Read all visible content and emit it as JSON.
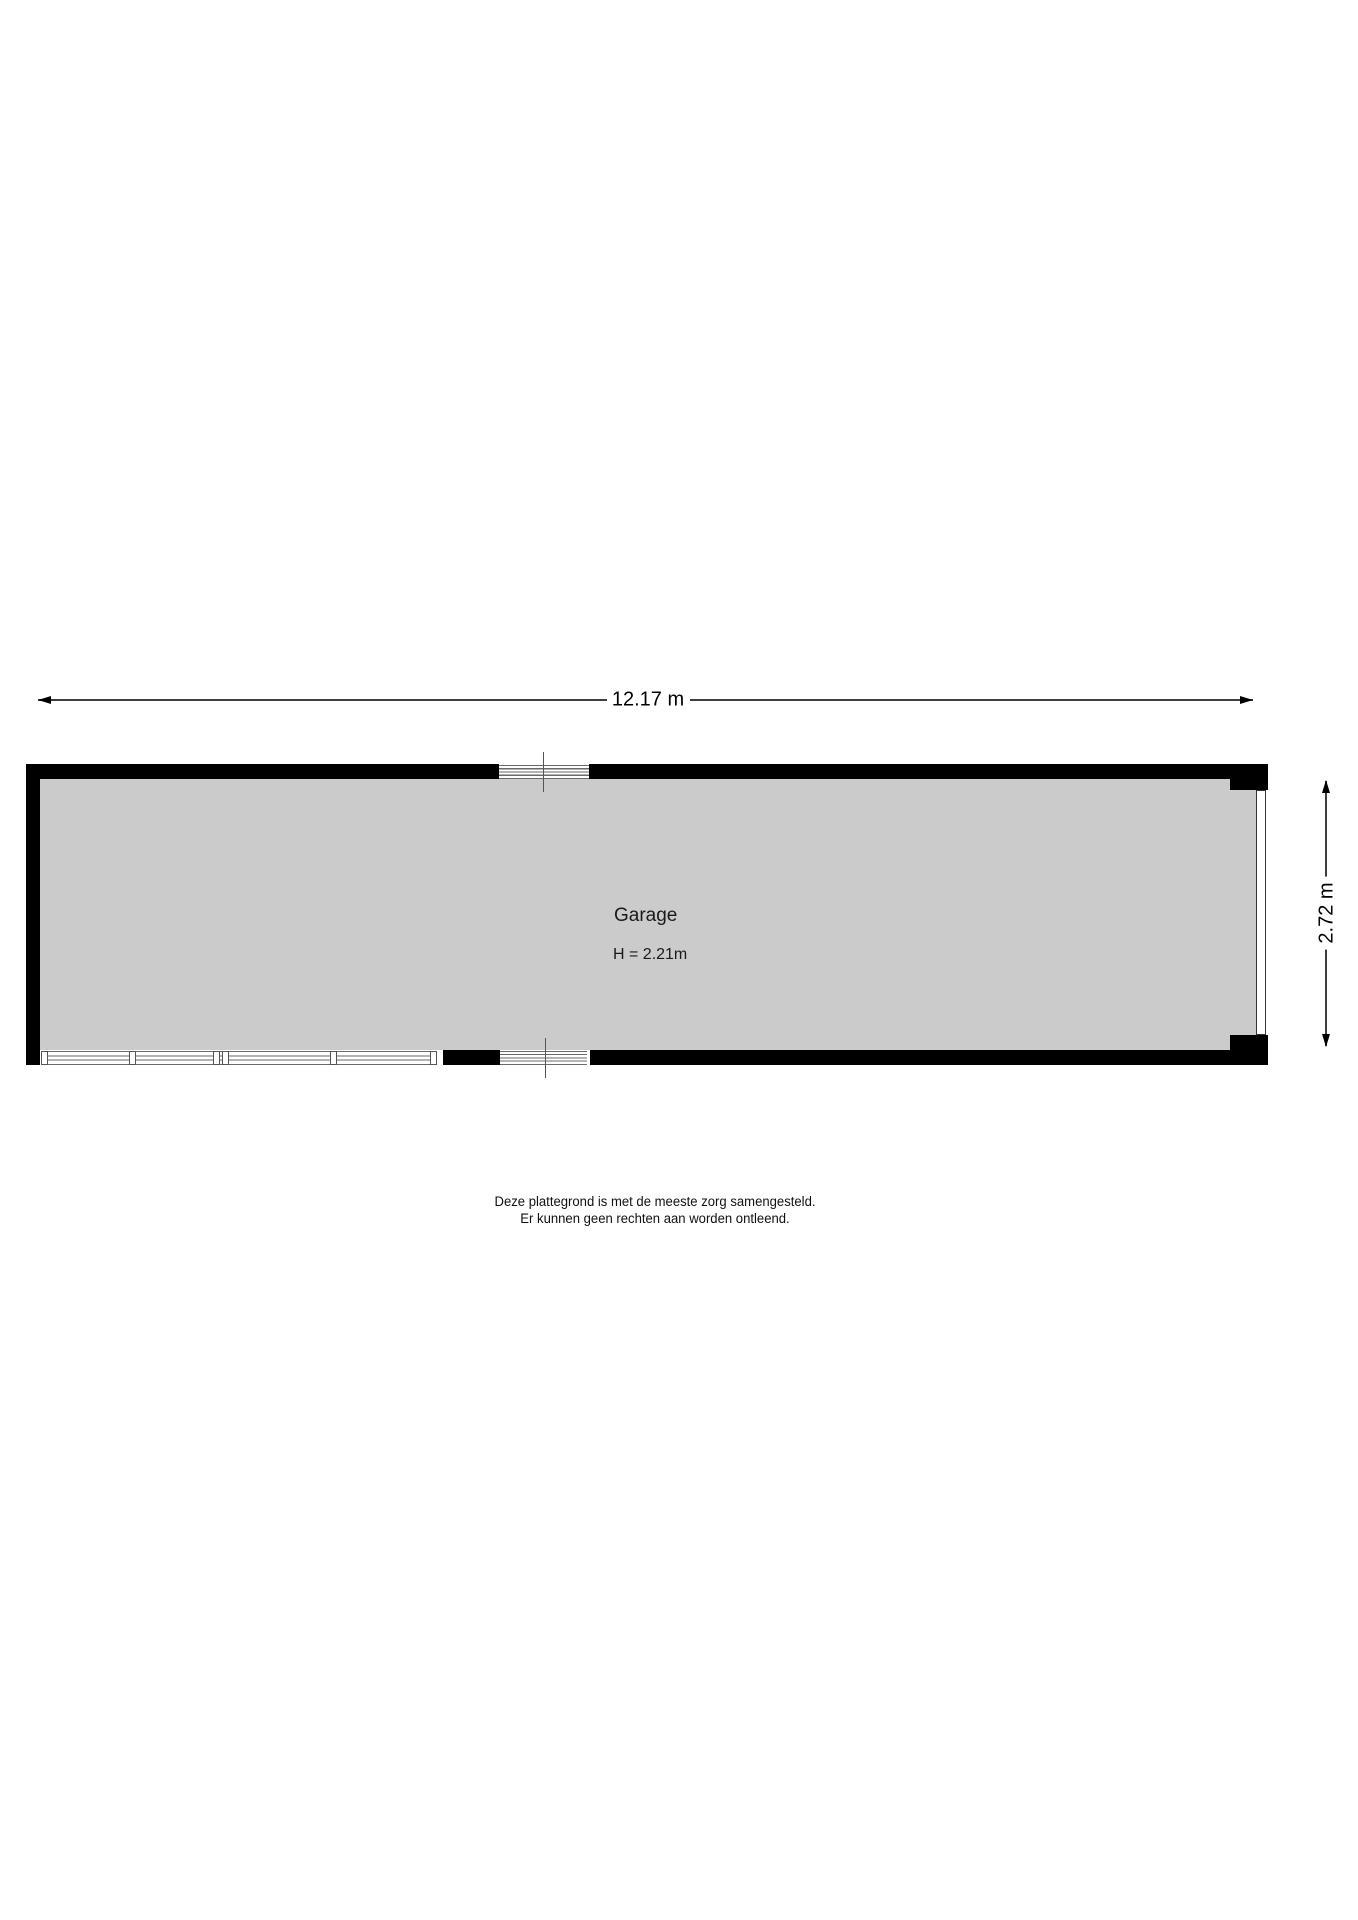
{
  "floorplan": {
    "room_label": "Garage",
    "room_height_label": "H = 2.21m",
    "width_dimension": "12.17 m",
    "height_dimension": "2.72 m",
    "disclaimer_line1": "Deze plattegrond is met de meeste zorg samengesteld.",
    "disclaimer_line2": "Er kunnen geen rechten aan worden ontleend.",
    "colors": {
      "wall": "#000000",
      "floor": "#cbcbcb",
      "window_line": "#6a6a6a",
      "dimension_line": "#3d3d3d",
      "background": "#ffffff"
    }
  }
}
